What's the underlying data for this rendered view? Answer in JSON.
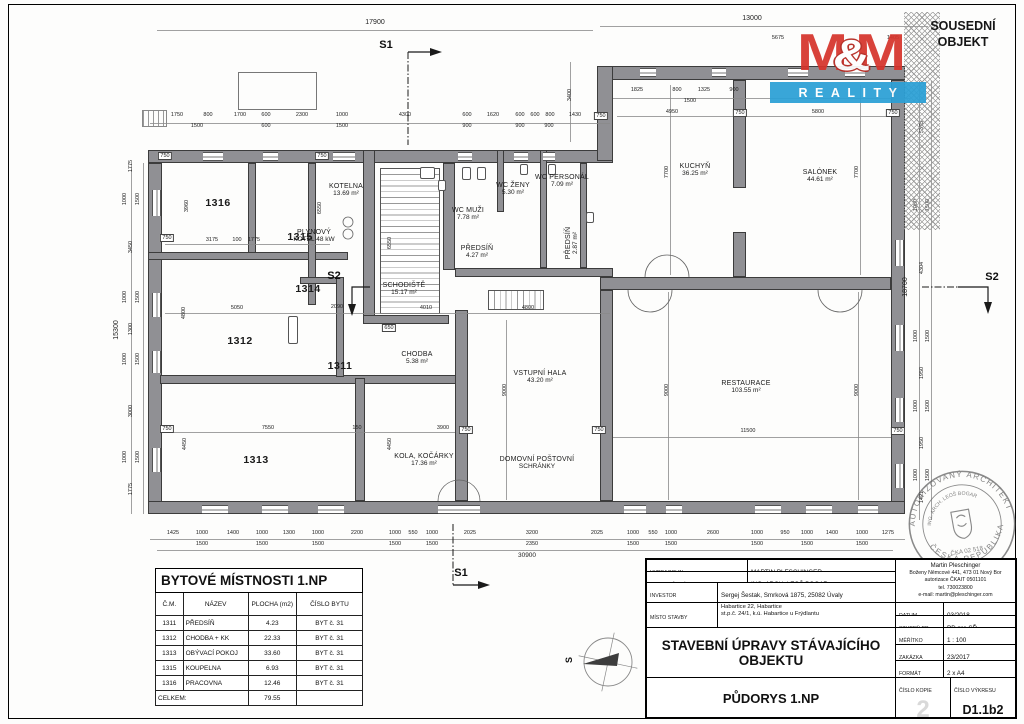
{
  "neighbor": {
    "line1": "SOUSEDNÍ",
    "line2": "OBJEKT"
  },
  "logo": {
    "m1": "M",
    "amp": "&",
    "m2": "M",
    "reality": "REALITY",
    "red": "#d6342c",
    "blue": "#2ba0d6"
  },
  "compass": {
    "north": "S"
  },
  "markers": {
    "s1": "S1",
    "s2": "S2"
  },
  "plan": {
    "rooms": [
      {
        "n": "1316",
        "x": 218,
        "y": 203,
        "num": 1
      },
      {
        "n": "1315",
        "x": 300,
        "y": 237,
        "num": 1
      },
      {
        "n": "1314",
        "x": 308,
        "y": 289,
        "num": 1
      },
      {
        "n": "1312",
        "x": 240,
        "y": 341,
        "num": 1
      },
      {
        "n": "1311",
        "x": 340,
        "y": 366,
        "num": 1
      },
      {
        "n": "1313",
        "x": 256,
        "y": 460,
        "num": 1
      },
      {
        "n": "KOTELNA",
        "a": "13.69 m²",
        "x": 346,
        "y": 190
      },
      {
        "n": "PLYNOVÝ",
        "a": "KOTEL 48 kW",
        "x": 314,
        "y": 236
      },
      {
        "n": "SCHODIŠTĚ",
        "a": "15.17 m²",
        "x": 404,
        "y": 289
      },
      {
        "n": "WC MUŽI",
        "a": "7.78 m²",
        "x": 468,
        "y": 214
      },
      {
        "n": "PŘEDSÍŇ",
        "a": "4.27 m²",
        "x": 477,
        "y": 252
      },
      {
        "n": "WC ŽENY",
        "a": "5.30 m²",
        "x": 513,
        "y": 189
      },
      {
        "n": "WC PERSONÁL",
        "a": "7.09 m²",
        "x": 562,
        "y": 181
      },
      {
        "n": "PŘEDSÍŇ",
        "a": "2.87 m²",
        "x": 572,
        "y": 243,
        "rot": 1
      },
      {
        "n": "CHODBA",
        "a": "5.38 m²",
        "x": 417,
        "y": 358
      },
      {
        "n": "VSTUPNÍ HALA",
        "a": "43.20 m²",
        "x": 540,
        "y": 377
      },
      {
        "n": "DOMOVNÍ POŠTOVNÍ",
        "a": "SCHRÁNKY",
        "x": 537,
        "y": 463
      },
      {
        "n": "KOLA, KOČÁRKY",
        "a": "17.36 m²",
        "x": 424,
        "y": 460
      },
      {
        "n": "KUCHYŇ",
        "a": "36.25 m²",
        "x": 695,
        "y": 170
      },
      {
        "n": "SALÓNEK",
        "a": "44.61 m²",
        "x": 820,
        "y": 176
      },
      {
        "n": "RESTAURACE",
        "a": "103.55 m²",
        "x": 746,
        "y": 387
      }
    ],
    "dims": [
      {
        "t": "17900",
        "x": 375,
        "y": 23,
        "s": 7
      },
      {
        "t": "13000",
        "x": 752,
        "y": 19,
        "s": 7
      },
      {
        "t": "1750",
        "x": 177,
        "y": 115
      },
      {
        "t": "800",
        "x": 208,
        "y": 115
      },
      {
        "t": "1700",
        "x": 240,
        "y": 115
      },
      {
        "t": "600",
        "x": 266,
        "y": 115
      },
      {
        "t": "2300",
        "x": 302,
        "y": 115
      },
      {
        "t": "1000",
        "x": 342,
        "y": 115
      },
      {
        "t": "4300",
        "x": 405,
        "y": 115
      },
      {
        "t": "600",
        "x": 467,
        "y": 115
      },
      {
        "t": "1620",
        "x": 493,
        "y": 115
      },
      {
        "t": "600",
        "x": 520,
        "y": 115
      },
      {
        "t": "600",
        "x": 535,
        "y": 115
      },
      {
        "t": "800",
        "x": 550,
        "y": 115
      },
      {
        "t": "1430",
        "x": 575,
        "y": 115
      },
      {
        "t": "1500",
        "x": 197,
        "y": 126
      },
      {
        "t": "600",
        "x": 266,
        "y": 126
      },
      {
        "t": "1500",
        "x": 342,
        "y": 126
      },
      {
        "t": "900",
        "x": 467,
        "y": 126
      },
      {
        "t": "900",
        "x": 520,
        "y": 126
      },
      {
        "t": "900",
        "x": 549,
        "y": 126
      },
      {
        "t": "3400",
        "x": 570,
        "y": 95,
        "r": 1
      },
      {
        "t": "1825",
        "x": 637,
        "y": 90
      },
      {
        "t": "800",
        "x": 677,
        "y": 90
      },
      {
        "t": "1325",
        "x": 704,
        "y": 90
      },
      {
        "t": "900",
        "x": 734,
        "y": 90
      },
      {
        "t": "1500",
        "x": 690,
        "y": 101
      },
      {
        "t": "5675",
        "x": 778,
        "y": 38
      },
      {
        "t": "1405",
        "x": 893,
        "y": 38
      },
      {
        "t": "750",
        "x": 165,
        "y": 156,
        "b": 1
      },
      {
        "t": "750",
        "x": 322,
        "y": 156,
        "b": 1
      },
      {
        "t": "750",
        "x": 601,
        "y": 116,
        "b": 1
      },
      {
        "t": "750",
        "x": 740,
        "y": 113,
        "b": 1
      },
      {
        "t": "750",
        "x": 893,
        "y": 113,
        "b": 1
      },
      {
        "t": "750",
        "x": 167,
        "y": 238,
        "b": 1
      },
      {
        "t": "750",
        "x": 167,
        "y": 429,
        "b": 1
      },
      {
        "t": "750",
        "x": 466,
        "y": 430,
        "b": 1
      },
      {
        "t": "750",
        "x": 599,
        "y": 430,
        "b": 1
      },
      {
        "t": "750",
        "x": 898,
        "y": 431,
        "b": 1
      },
      {
        "t": "650",
        "x": 389,
        "y": 328,
        "b": 1
      },
      {
        "t": "3960",
        "x": 187,
        "y": 206,
        "r": 1
      },
      {
        "t": "3175",
        "x": 212,
        "y": 240
      },
      {
        "t": "100",
        "x": 237,
        "y": 240
      },
      {
        "t": "1775",
        "x": 254,
        "y": 240
      },
      {
        "t": "6550",
        "x": 320,
        "y": 208,
        "r": 1
      },
      {
        "t": "6550",
        "x": 390,
        "y": 243,
        "r": 1
      },
      {
        "t": "5050",
        "x": 237,
        "y": 308
      },
      {
        "t": "2090",
        "x": 337,
        "y": 307
      },
      {
        "t": "4800",
        "x": 184,
        "y": 313,
        "r": 1
      },
      {
        "t": "4010",
        "x": 426,
        "y": 308
      },
      {
        "t": "4800",
        "x": 528,
        "y": 308
      },
      {
        "t": "7550",
        "x": 268,
        "y": 428
      },
      {
        "t": "150",
        "x": 357,
        "y": 428
      },
      {
        "t": "3900",
        "x": 443,
        "y": 428
      },
      {
        "t": "4450",
        "x": 185,
        "y": 444,
        "r": 1
      },
      {
        "t": "4450",
        "x": 390,
        "y": 444,
        "r": 1
      },
      {
        "t": "4950",
        "x": 672,
        "y": 112
      },
      {
        "t": "5800",
        "x": 818,
        "y": 112
      },
      {
        "t": "7700",
        "x": 667,
        "y": 172,
        "r": 1
      },
      {
        "t": "7700",
        "x": 857,
        "y": 172,
        "r": 1
      },
      {
        "t": "9000",
        "x": 505,
        "y": 390,
        "r": 1
      },
      {
        "t": "9000",
        "x": 667,
        "y": 390,
        "r": 1
      },
      {
        "t": "9000",
        "x": 857,
        "y": 390,
        "r": 1
      },
      {
        "t": "11500",
        "x": 748,
        "y": 431
      },
      {
        "t": "15300",
        "x": 117,
        "y": 330,
        "r": 1,
        "s": 7
      },
      {
        "t": "1775",
        "x": 131,
        "y": 166,
        "r": 1
      },
      {
        "t": "3450",
        "x": 131,
        "y": 247,
        "r": 1
      },
      {
        "t": "1300",
        "x": 131,
        "y": 329,
        "r": 1
      },
      {
        "t": "3000",
        "x": 131,
        "y": 411,
        "r": 1
      },
      {
        "t": "1775",
        "x": 131,
        "y": 489,
        "r": 1
      },
      {
        "t": "1000",
        "x": 125,
        "y": 199,
        "r": 1
      },
      {
        "t": "1500",
        "x": 138,
        "y": 199,
        "r": 1
      },
      {
        "t": "1000",
        "x": 125,
        "y": 297,
        "r": 1
      },
      {
        "t": "1500",
        "x": 138,
        "y": 297,
        "r": 1
      },
      {
        "t": "1000",
        "x": 125,
        "y": 359,
        "r": 1
      },
      {
        "t": "1500",
        "x": 138,
        "y": 359,
        "r": 1
      },
      {
        "t": "1000",
        "x": 125,
        "y": 457,
        "r": 1
      },
      {
        "t": "1500",
        "x": 138,
        "y": 457,
        "r": 1
      },
      {
        "t": "18700",
        "x": 906,
        "y": 287,
        "r": 1,
        "s": 7
      },
      {
        "t": "5375",
        "x": 922,
        "y": 127,
        "r": 1
      },
      {
        "t": "4304",
        "x": 922,
        "y": 268,
        "r": 1
      },
      {
        "t": "1950",
        "x": 922,
        "y": 373,
        "r": 1
      },
      {
        "t": "1950",
        "x": 922,
        "y": 443,
        "r": 1
      },
      {
        "t": "1421",
        "x": 922,
        "y": 497,
        "r": 1
      },
      {
        "t": "1000",
        "x": 916,
        "y": 205,
        "r": 1
      },
      {
        "t": "1500",
        "x": 928,
        "y": 205,
        "r": 1
      },
      {
        "t": "1000",
        "x": 916,
        "y": 336,
        "r": 1
      },
      {
        "t": "1500",
        "x": 928,
        "y": 336,
        "r": 1
      },
      {
        "t": "1000",
        "x": 916,
        "y": 406,
        "r": 1
      },
      {
        "t": "1500",
        "x": 928,
        "y": 406,
        "r": 1
      },
      {
        "t": "1000",
        "x": 916,
        "y": 475,
        "r": 1
      },
      {
        "t": "1500",
        "x": 928,
        "y": 475,
        "r": 1
      },
      {
        "t": "1425",
        "x": 173,
        "y": 533
      },
      {
        "t": "1000",
        "x": 202,
        "y": 533
      },
      {
        "t": "1400",
        "x": 233,
        "y": 533
      },
      {
        "t": "1000",
        "x": 262,
        "y": 533
      },
      {
        "t": "1300",
        "x": 289,
        "y": 533
      },
      {
        "t": "1000",
        "x": 318,
        "y": 533
      },
      {
        "t": "2200",
        "x": 357,
        "y": 533
      },
      {
        "t": "1000",
        "x": 395,
        "y": 533
      },
      {
        "t": "550",
        "x": 413,
        "y": 533
      },
      {
        "t": "1000",
        "x": 432,
        "y": 533
      },
      {
        "t": "2025",
        "x": 470,
        "y": 533
      },
      {
        "t": "3200",
        "x": 532,
        "y": 533
      },
      {
        "t": "2025",
        "x": 597,
        "y": 533
      },
      {
        "t": "1000",
        "x": 633,
        "y": 533
      },
      {
        "t": "550",
        "x": 653,
        "y": 533
      },
      {
        "t": "1000",
        "x": 671,
        "y": 533
      },
      {
        "t": "2600",
        "x": 713,
        "y": 533
      },
      {
        "t": "1000",
        "x": 757,
        "y": 533
      },
      {
        "t": "950",
        "x": 785,
        "y": 533
      },
      {
        "t": "1000",
        "x": 807,
        "y": 533
      },
      {
        "t": "1400",
        "x": 832,
        "y": 533
      },
      {
        "t": "1000",
        "x": 862,
        "y": 533
      },
      {
        "t": "1275",
        "x": 888,
        "y": 533
      },
      {
        "t": "1500",
        "x": 202,
        "y": 544
      },
      {
        "t": "1500",
        "x": 262,
        "y": 544
      },
      {
        "t": "1500",
        "x": 318,
        "y": 544
      },
      {
        "t": "1500",
        "x": 395,
        "y": 544
      },
      {
        "t": "1500",
        "x": 432,
        "y": 544
      },
      {
        "t": "2350",
        "x": 532,
        "y": 544
      },
      {
        "t": "1500",
        "x": 633,
        "y": 544
      },
      {
        "t": "1500",
        "x": 671,
        "y": 544
      },
      {
        "t": "1500",
        "x": 757,
        "y": 544
      },
      {
        "t": "1500",
        "x": 807,
        "y": 544
      },
      {
        "t": "1500",
        "x": 862,
        "y": 544
      },
      {
        "t": "30900",
        "x": 527,
        "y": 556,
        "s": 6.5
      }
    ]
  },
  "rooms_table": {
    "title": "BYTOVÉ MÍSTNOSTI 1.NP",
    "headers": [
      "Č.M.",
      "NÁZEV",
      "PLOCHA (m2)",
      "ČÍSLO BYTU"
    ],
    "rows": [
      [
        "1311",
        "PŘEDSÍŇ",
        "4.23",
        "BYT č. 31"
      ],
      [
        "1312",
        "CHODBA + KK",
        "22.33",
        "BYT č. 31"
      ],
      [
        "1313",
        "OBÝVACÍ POKOJ",
        "33.60",
        "BYT č. 31"
      ],
      [
        "1315",
        "KOUPELNA",
        "6.93",
        "BYT č. 31"
      ],
      [
        "1316",
        "PRACOVNA",
        "12.46",
        "BYT č. 31"
      ]
    ],
    "total_label": "CELKEM:",
    "total": "79.55"
  },
  "titleblock": {
    "vypracoval_label": "VYPRACOVAL",
    "vypracoval": "MARTIN PLESCHINGER",
    "projektant_label": "ZODPOVĚDNÝ PROJEKTANT",
    "projektant": "ING. ARCH. LEOŠ BOGAR",
    "investor_label": "INVESTOR",
    "investor": "Sergej Šestak, Smrková 1875, 25082 Úvaly",
    "misto_label": "MÍSTO STAVBY",
    "misto1": "Habartice 22, Habartice",
    "misto2": "st.p.č. 24/1, k.ú. Habartice u Frýdlantu",
    "project_title": "STAVEBNÍ ÚPRAVY STÁVAJÍCÍHO OBJEKTU",
    "drawing_title": "PŮDORYS 1.NP",
    "contact": [
      "Martin Pleschinger",
      "Boženy Němcové 441, 473 01 Nový Bor",
      "autorizace ČKAIT 0501101",
      "tel. 730023800",
      "e-mail: martin@pleschinger.com"
    ],
    "datum_label": "DATUM",
    "datum": "03/2018",
    "stupen_label": "STUPEŇ PD",
    "stupen": "PD pro SŘ",
    "meritko_label": "MĚŘÍTKO",
    "meritko": "1 : 100",
    "zakazka_label": "ZAKÁZKA",
    "zakazka": "23/2017",
    "format_label": "FORMÁT",
    "format": "2 x A4",
    "kopie_label": "ČÍSLO KOPIE",
    "kopie": "2",
    "vykres_label": "ČÍSLO VÝKRESU",
    "vykres": "D1.1b2"
  },
  "stamp": {
    "ring_top": "AUTORIZOVANÝ ARCHITEKT",
    "ring_bottom": "ČESKÁ REPUBLIKA",
    "inner_top": "ING. ARCH. LEOŠ BOGAR",
    "inner_bottom": "ČKA 02 518"
  }
}
